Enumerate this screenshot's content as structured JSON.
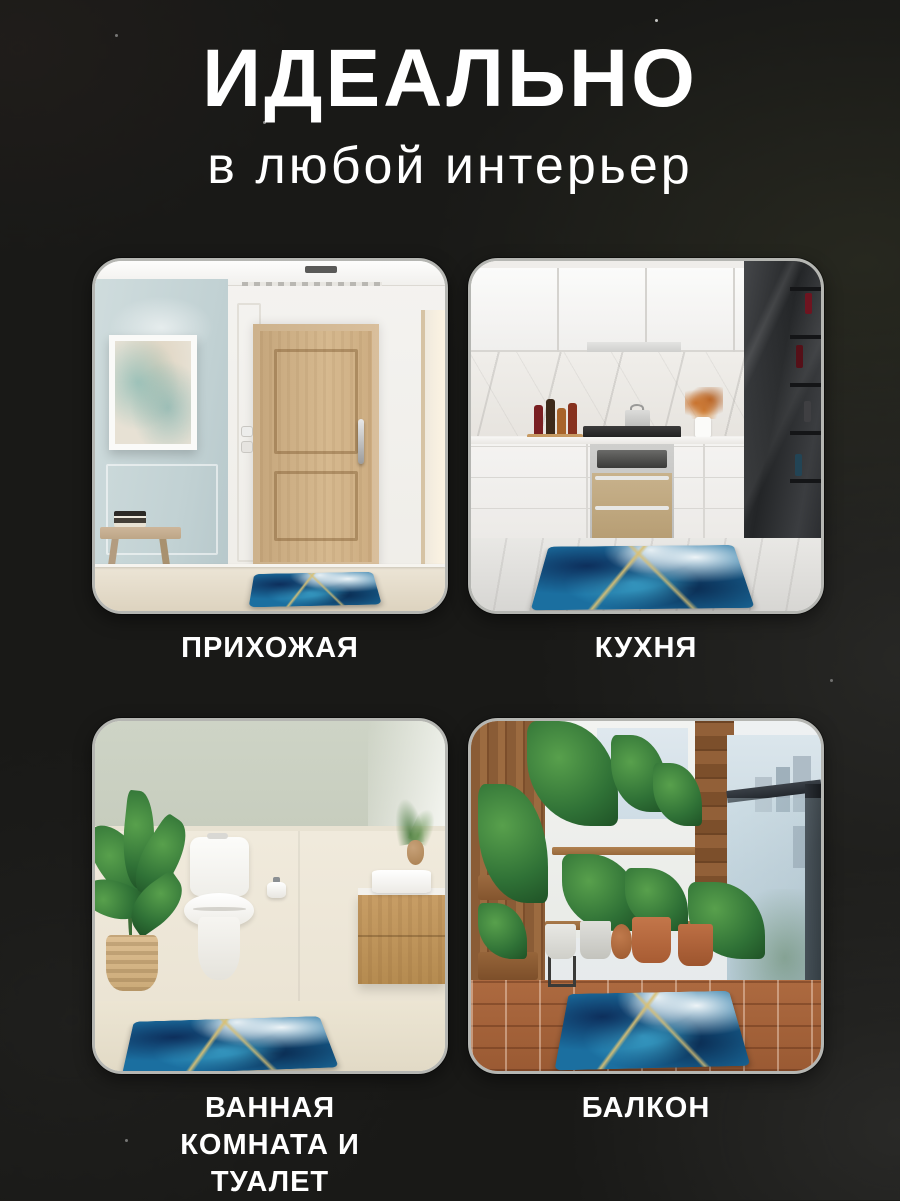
{
  "header": {
    "title": "ИДЕАЛЬНО",
    "subtitle": "в любой интерьер"
  },
  "cards": [
    {
      "id": "hallway",
      "label": "ПРИХОЖАЯ"
    },
    {
      "id": "kitchen",
      "label": "КУХНЯ"
    },
    {
      "id": "bathroom",
      "label": "ВАННАЯ КОМНАТА И ТУАЛЕТ"
    },
    {
      "id": "balcony",
      "label": "БАЛКОН"
    }
  ],
  "style": {
    "background": "#191917",
    "text_color": "#ffffff",
    "card_border": "#b5b6b2",
    "mat_palette": {
      "navy": "#0d2f5c",
      "blue": "#1b6fa0",
      "cyan": "#3fb0d8",
      "ice": "#eef4f7",
      "gold": "#d9c073"
    }
  }
}
